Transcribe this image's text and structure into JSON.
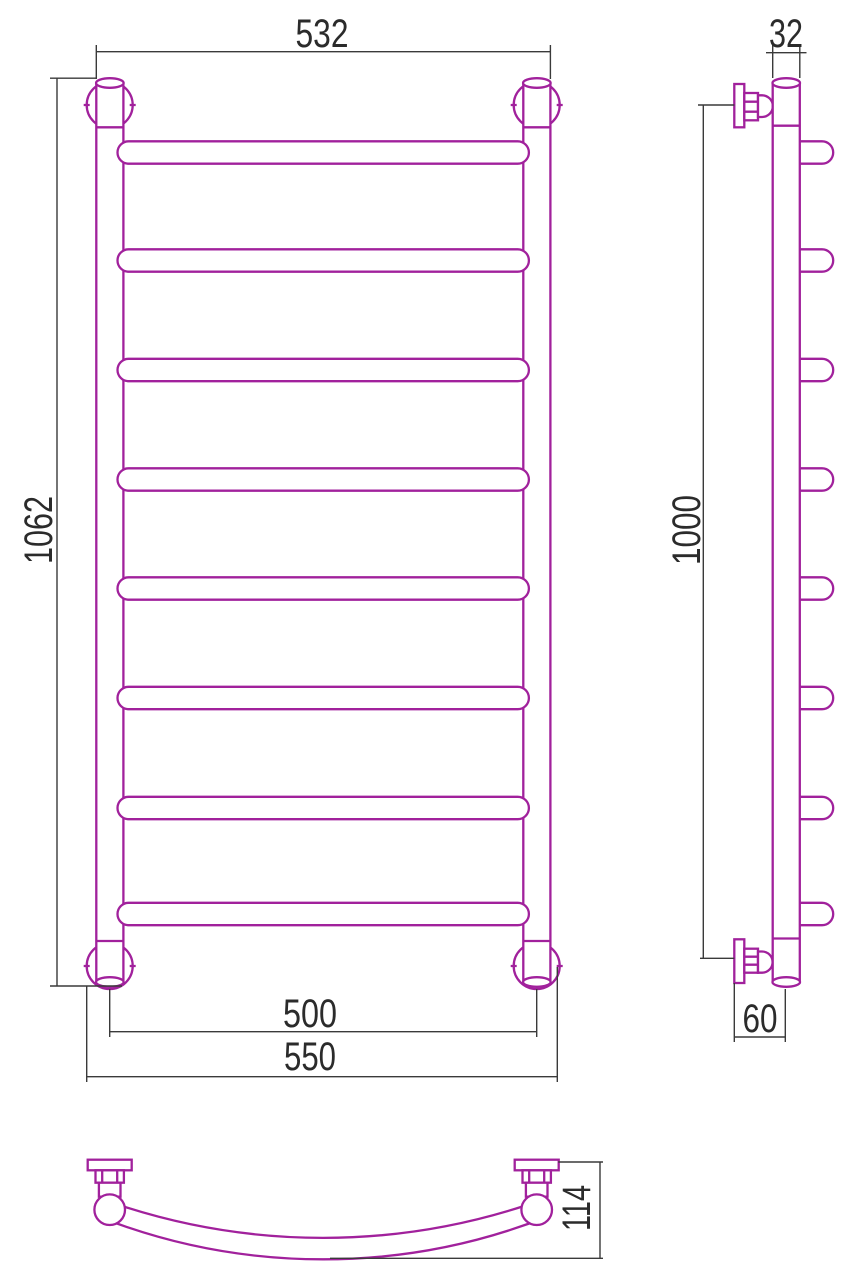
{
  "colors": {
    "outline": "#A1219C",
    "dimension": "#3A3A3A",
    "background": "#FFFFFF"
  },
  "views": {
    "front": {
      "rung_count": 8,
      "dims": {
        "top_width": "532",
        "height": "1062",
        "bottom_inner_width": "500",
        "bottom_outer_width": "550"
      }
    },
    "side": {
      "stub_count": 8,
      "dims": {
        "tube_width": "32",
        "mount_height": "1000",
        "bottom_offset": "60"
      }
    },
    "bottom": {
      "dims": {
        "curve_depth": "114"
      }
    }
  }
}
